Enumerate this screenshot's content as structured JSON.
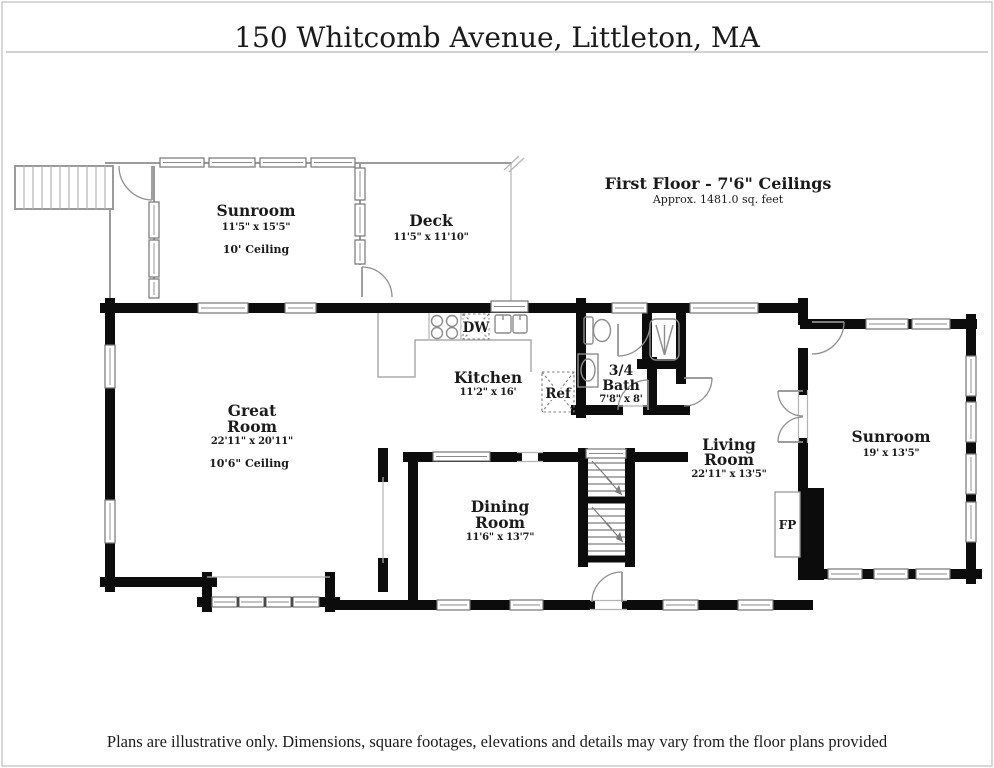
{
  "page": {
    "title": "150 Whitcomb Avenue, Littleton, MA",
    "disclaimer": "Plans are illustrative only. Dimensions, square footages, elevations and details may vary from the floor plans provided"
  },
  "plan": {
    "floor_label": "First Floor - 7'6\" Ceilings",
    "floor_area": "Approx. 1481.0 sq. feet",
    "rooms": {
      "sunroom_nw": {
        "name": "Sunroom",
        "dims": "11'5\" x 15'5\"",
        "ceiling": "10' Ceiling"
      },
      "deck": {
        "name": "Deck",
        "dims": "11'5\" x 11'10\""
      },
      "kitchen": {
        "name": "Kitchen",
        "dims": "11'2\" x 16'"
      },
      "bath": {
        "name1": "3/4",
        "name2": "Bath",
        "dims": "7'8\" x 8'"
      },
      "great_room": {
        "name1": "Great",
        "name2": "Room",
        "dims": "22'11\" x 20'11\"",
        "ceiling": "10'6\" Ceiling"
      },
      "dining_room": {
        "name1": "Dining",
        "name2": "Room",
        "dims": "11'6\" x 13'7\""
      },
      "living_room": {
        "name1": "Living",
        "name2": "Room",
        "dims": "22'11\" x 13'5\""
      },
      "sunroom_e": {
        "name": "Sunroom",
        "dims": "19' x 13'5\""
      }
    },
    "fixtures": {
      "dishwasher": "DW",
      "refrigerator": "Ref",
      "fireplace": "FP"
    }
  }
}
